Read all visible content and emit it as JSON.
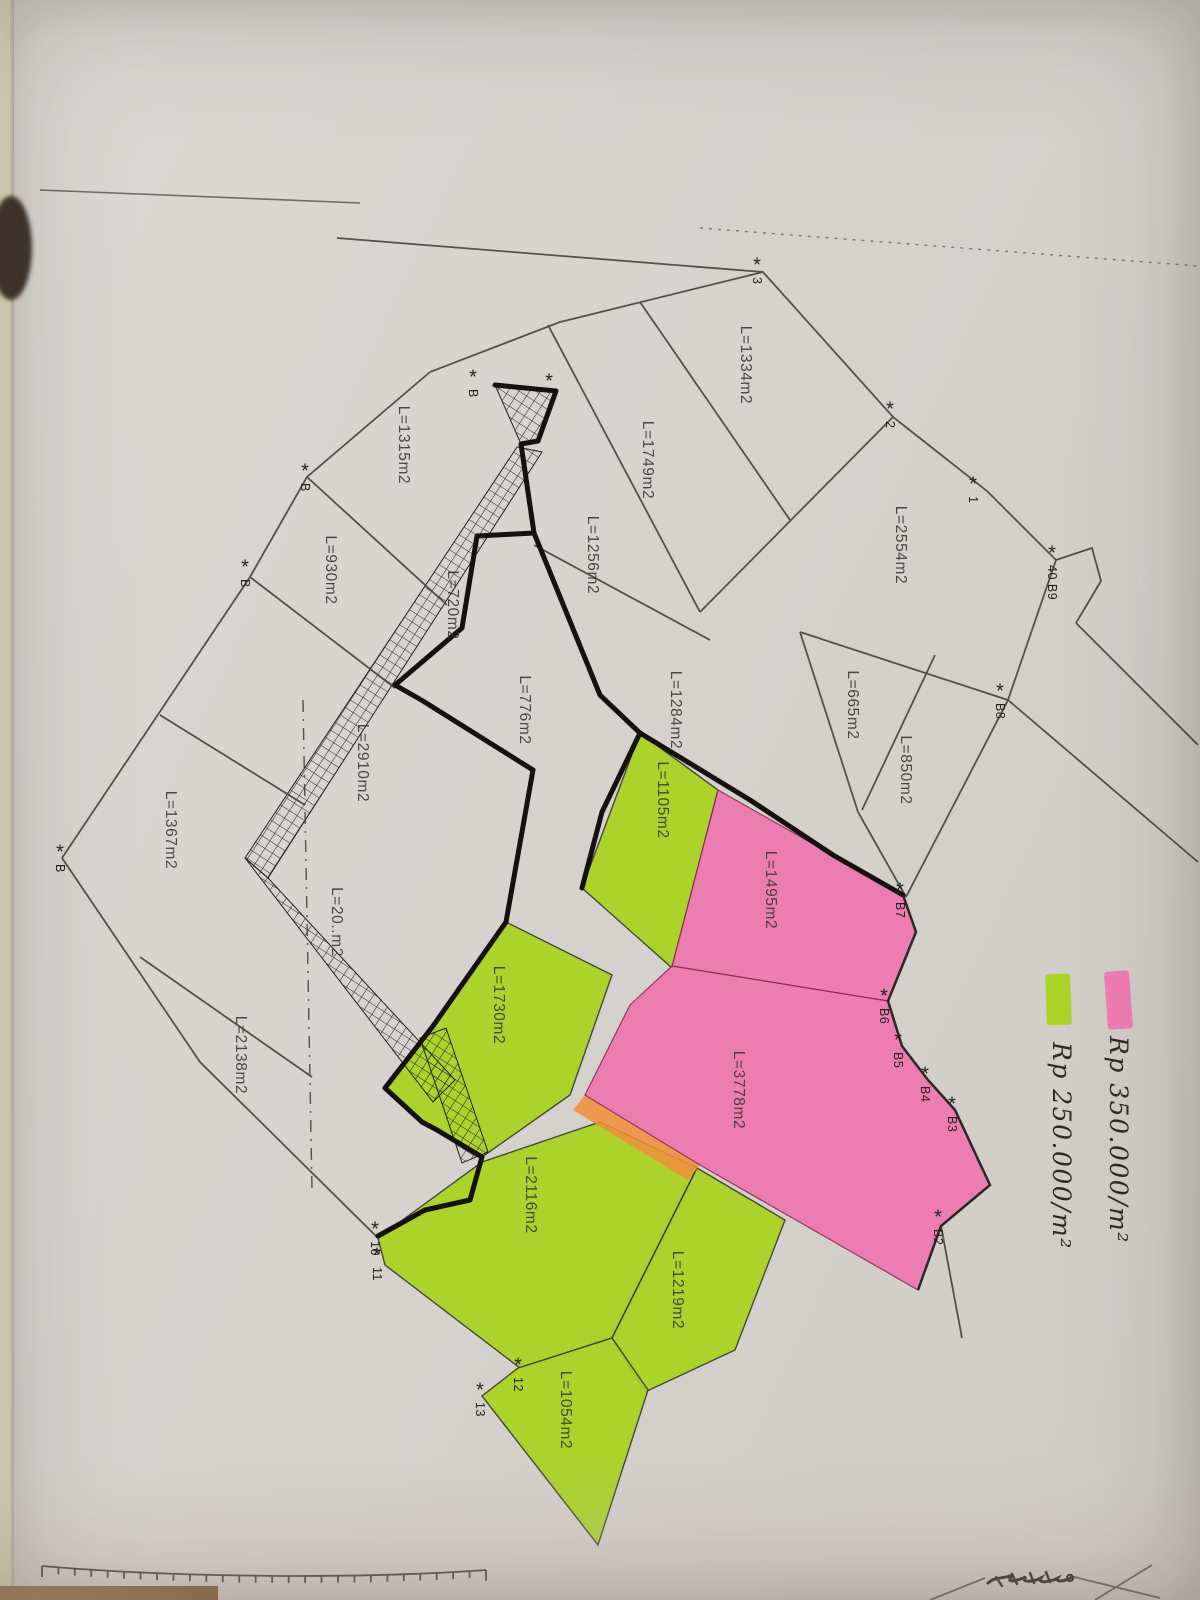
{
  "legend": {
    "items": [
      {
        "name": "pink",
        "label": "Rp 350.000/m²"
      },
      {
        "name": "green",
        "label": "Rp 250.000/m²"
      }
    ]
  },
  "map": {
    "parcels": [
      {
        "label": "L=1334m2",
        "x": 745,
        "y": 365,
        "highlight": "none"
      },
      {
        "label": "L=1749m2",
        "x": 647,
        "y": 460,
        "highlight": "none"
      },
      {
        "label": "L=2554m2",
        "x": 900,
        "y": 545,
        "highlight": "none"
      },
      {
        "label": "L=1256m2",
        "x": 592,
        "y": 555,
        "highlight": "none"
      },
      {
        "label": "L=1315m2",
        "x": 403,
        "y": 445,
        "highlight": "none"
      },
      {
        "label": "L=930m2",
        "x": 330,
        "y": 570,
        "highlight": "none"
      },
      {
        "label": "L=720m2",
        "x": 452,
        "y": 605,
        "highlight": "none"
      },
      {
        "label": "L=776m2",
        "x": 524,
        "y": 710,
        "highlight": "none"
      },
      {
        "label": "L=1284m2",
        "x": 675,
        "y": 710,
        "highlight": "none"
      },
      {
        "label": "L=665m2",
        "x": 852,
        "y": 705,
        "highlight": "none"
      },
      {
        "label": "L=850m2",
        "x": 905,
        "y": 770,
        "highlight": "none"
      },
      {
        "label": "L=2910m2",
        "x": 362,
        "y": 763,
        "highlight": "none"
      },
      {
        "label": "L=1367m2",
        "x": 170,
        "y": 830,
        "highlight": "none"
      },
      {
        "label": "L=20..m2",
        "x": 336,
        "y": 922,
        "highlight": "none",
        "obscured": true
      },
      {
        "label": "L=2138m2",
        "x": 240,
        "y": 1055,
        "highlight": "none"
      },
      {
        "label": "L=1105m2",
        "x": 662,
        "y": 800,
        "highlight": "green"
      },
      {
        "label": "L=1495m2",
        "x": 770,
        "y": 890,
        "highlight": "pink"
      },
      {
        "label": "L=1730m2",
        "x": 498,
        "y": 1005,
        "highlight": "green"
      },
      {
        "label": "L=3778m2",
        "x": 738,
        "y": 1090,
        "highlight": "pink"
      },
      {
        "label": "L=2116m2",
        "x": 530,
        "y": 1195,
        "highlight": "green"
      },
      {
        "label": "L=1219m2",
        "x": 677,
        "y": 1290,
        "highlight": "green"
      },
      {
        "label": "L=1054m2",
        "x": 565,
        "y": 1410,
        "highlight": "green"
      }
    ],
    "markers": [
      {
        "label": "3",
        "x": 757,
        "y": 268
      },
      {
        "label": "2",
        "x": 890,
        "y": 412
      },
      {
        "label": "1",
        "x": 973,
        "y": 487
      },
      {
        "label": "40.B9",
        "x": 1052,
        "y": 556
      },
      {
        "label": "B8",
        "x": 1000,
        "y": 694
      },
      {
        "label": "B7",
        "x": 900,
        "y": 893
      },
      {
        "label": "B6",
        "x": 884,
        "y": 999
      },
      {
        "label": "B5",
        "x": 898,
        "y": 1043
      },
      {
        "label": "B4",
        "x": 925,
        "y": 1077
      },
      {
        "label": "B3",
        "x": 952,
        "y": 1107
      },
      {
        "label": "B2",
        "x": 938,
        "y": 1220
      },
      {
        "label": "B",
        "x": 473,
        "y": 380
      },
      {
        "label": "",
        "x": 549,
        "y": 384
      },
      {
        "label": "B",
        "x": 305,
        "y": 474
      },
      {
        "label": "B",
        "x": 245,
        "y": 570
      },
      {
        "label": "B",
        "x": 60,
        "y": 855
      },
      {
        "label": "10",
        "x": 375,
        "y": 1232
      },
      {
        "label": "11",
        "x": 377,
        "y": 1258
      },
      {
        "label": "12",
        "x": 518,
        "y": 1368
      },
      {
        "label": "13",
        "x": 480,
        "y": 1393
      }
    ]
  },
  "colors": {
    "paper": "#d6d3cf",
    "line": "#45423c",
    "bold_line": "#14110e",
    "green": "#a8d41f",
    "pink": "#ef74af",
    "orange": "#ef8f3c",
    "legend_pink": "#f277b2",
    "legend_green": "#a9d41f"
  },
  "footer": {
    "scale_bar_ticks": 28
  }
}
